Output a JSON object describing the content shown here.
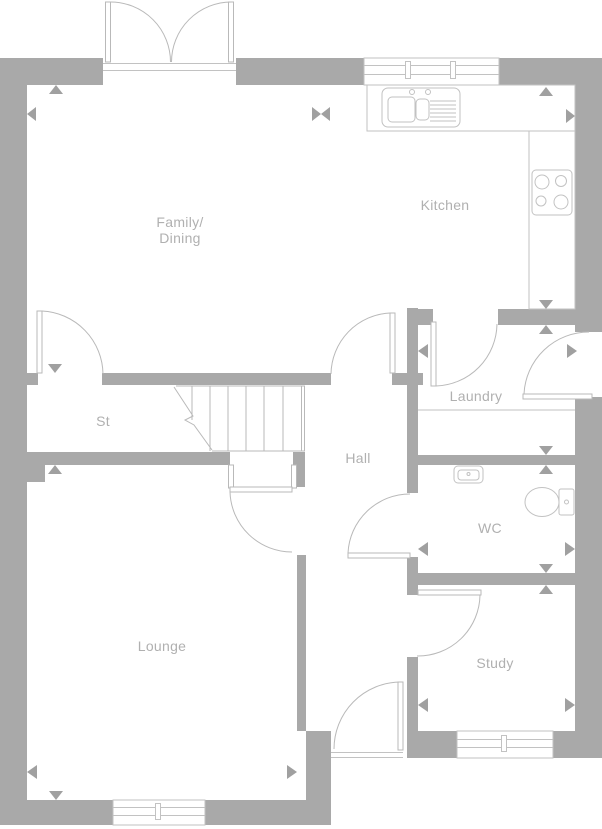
{
  "colors": {
    "wall": "#a9a9a9",
    "line": "#b9b9b9",
    "fixline": "#c2c2c2",
    "label": "#b0b0b0",
    "marker": "#a0a0a0",
    "background": "#ffffff"
  },
  "rooms": {
    "family_dining": {
      "line1": "Family/",
      "line2": "Dining"
    },
    "kitchen": {
      "label": "Kitchen"
    },
    "st": {
      "label": "St"
    },
    "hall": {
      "label": "Hall"
    },
    "laundry": {
      "label": "Laundry"
    },
    "wc": {
      "label": "WC"
    },
    "lounge": {
      "label": "Lounge"
    },
    "study": {
      "label": "Study"
    }
  },
  "fixtures": [
    "patio-doors",
    "kitchen-window",
    "lounge-window",
    "study-window",
    "kitchen-sink",
    "hob",
    "kitchen-worktop",
    "laundry-worktop",
    "wc-basin",
    "toilet",
    "stairs",
    "front-door",
    "side-door",
    "junction-markers"
  ]
}
